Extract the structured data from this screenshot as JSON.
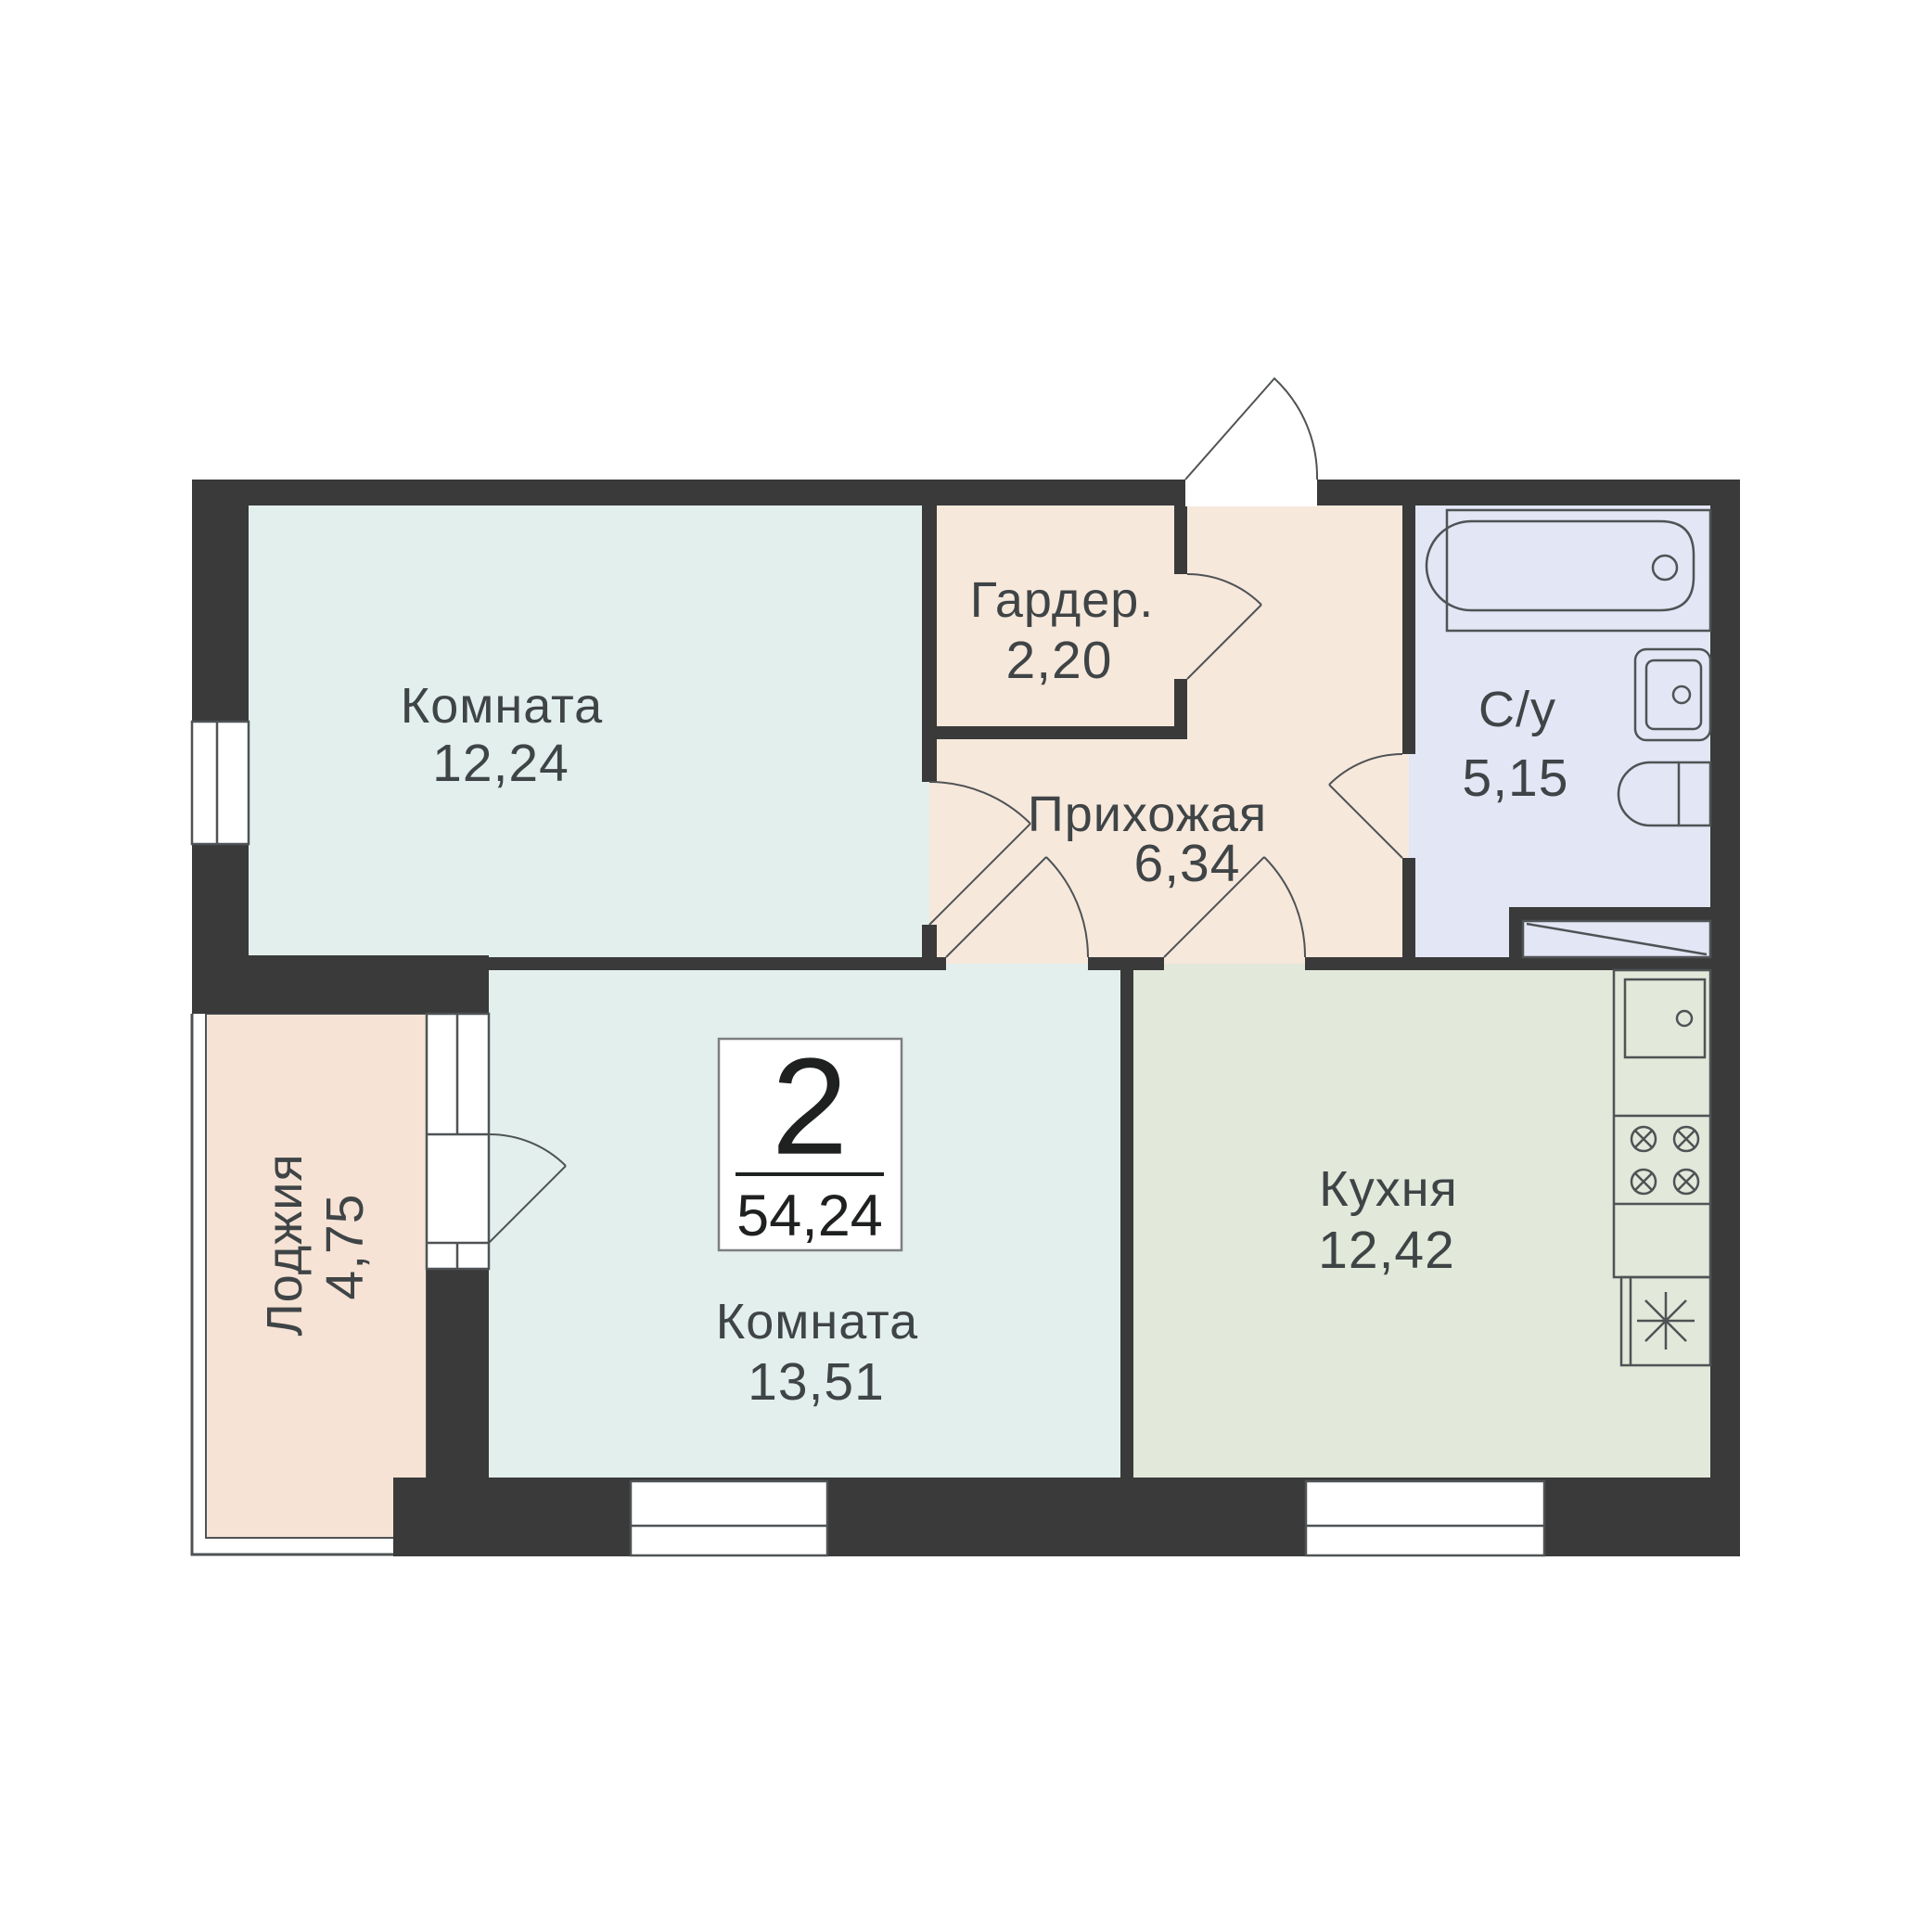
{
  "floor_plan": {
    "badge": {
      "rooms_count": "2",
      "total_area": "54,24"
    },
    "rooms": [
      {
        "key": "living-room-1",
        "label": "Комната",
        "area": "12,24"
      },
      {
        "key": "wardrobe",
        "label": "Гардер.",
        "area": "2,20"
      },
      {
        "key": "hallway",
        "label": "Прихожая",
        "area": "6,34"
      },
      {
        "key": "bathroom",
        "label": "С/у",
        "area": "5,15"
      },
      {
        "key": "living-room-2",
        "label": "Комната",
        "area": "13,51"
      },
      {
        "key": "kitchen",
        "label": "Кухня",
        "area": "12,42"
      },
      {
        "key": "loggia",
        "label": "Лоджия",
        "area": "4,75"
      }
    ],
    "fixtures": [
      "bathtub-icon",
      "bathroom-sink-icon",
      "toilet-icon",
      "duct-panel-icon",
      "kitchen-sink-icon",
      "stove-burners-icon",
      "fridge-snowflake-icon",
      "window-icon",
      "door-swing-icon"
    ],
    "colors": {
      "wall": "#3a3a3a",
      "room": "#e2efed",
      "hall": "#f7e8dc",
      "bathroom": "#e2e6f5",
      "kitchen": "#e2e8da",
      "loggia": "#f6e3d5",
      "line": "#4f5355",
      "text": "#3f4446",
      "badge_text": "#1f2121"
    }
  }
}
